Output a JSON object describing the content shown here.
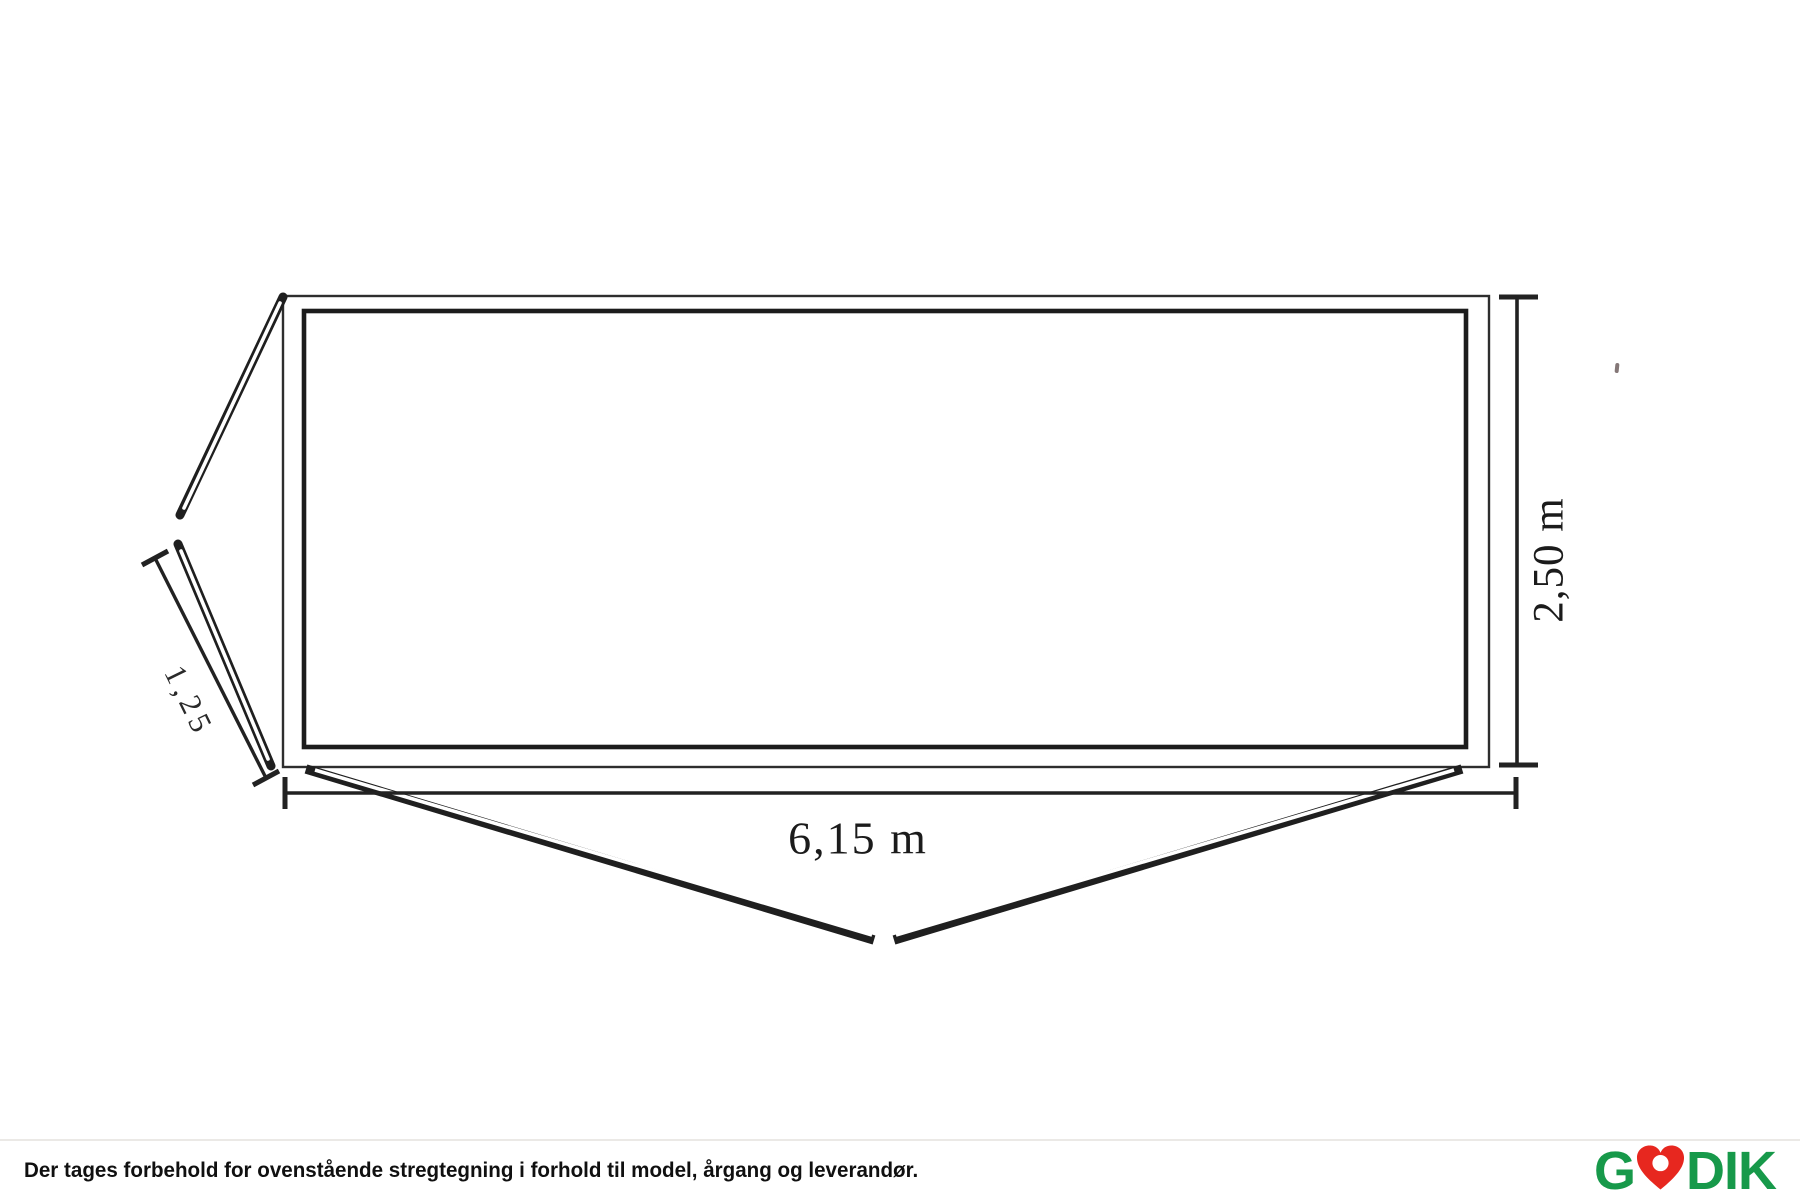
{
  "diagram": {
    "width_label": "6,15 m",
    "height_label": "2,50 m",
    "side_label": "1,25"
  },
  "footer": {
    "disclaimer": "Der tages forbehold for ovenstående stregtegning i forhold til model, årgang og leverandør.",
    "logo_prefix": "G",
    "logo_suffix": "DIK",
    "logo_heart": "heart-icon"
  },
  "colors": {
    "line": "#1f1f1f",
    "logo_green": "#17994a",
    "logo_red": "#e7271f"
  }
}
